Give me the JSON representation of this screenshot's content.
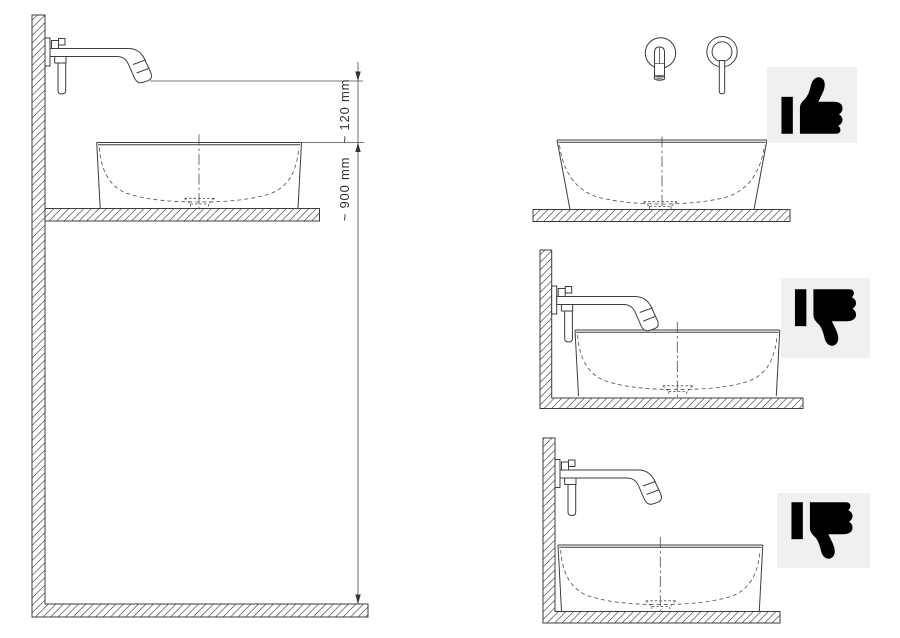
{
  "diagram": {
    "dimensions": {
      "spout_to_rim": "~ 120 mm",
      "rim_to_floor": "~ 900 mm"
    },
    "icons": {
      "top_right": "thumbs-up-icon",
      "middle_right": "thumbs-down-icon",
      "bottom_right": "thumbs-down-icon"
    },
    "colors": {
      "line": "#3d3d3d",
      "text": "#333333",
      "icon_background": "#f0f0f0",
      "icon_glyph": "#000000",
      "background": "#ffffff"
    }
  }
}
